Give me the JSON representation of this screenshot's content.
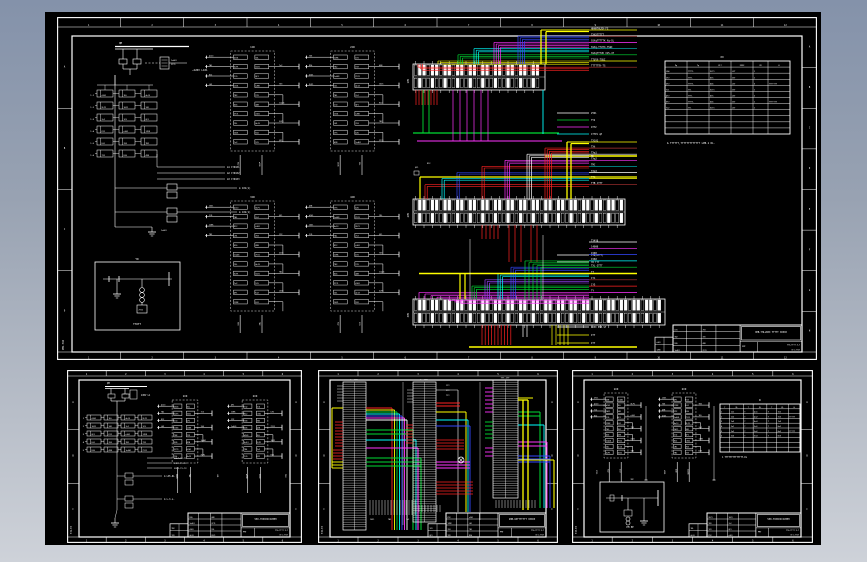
{
  "viewport": {
    "description": "CAD drawing preview",
    "background_top": "#8492aa",
    "background_bottom": "#ced2d9",
    "canvas_color": "#000000",
    "line_color": "#ffffff"
  },
  "wire_colors": {
    "red": "#ff2222",
    "darkred": "#b03434",
    "yellow": "#ffff00",
    "green": "#00dd33",
    "teal": "#00a0a0",
    "cyan": "#00ffff",
    "blue": "#3448ff",
    "magenta": "#ff33ff",
    "violet": "#9a44ff",
    "white": "#ffffff"
  },
  "smudges": [
    "1n401",
    "2YJ1",
    "d101",
    "1DL",
    "4n13",
    "XLP1",
    "1021",
    "TA1",
    "7n2",
    "1CD",
    "QF1",
    "K12",
    "n301",
    "1ZKK",
    "LH1",
    "703",
    "TB2",
    "1YX",
    "D26",
    "4XB"
  ],
  "sheets": {
    "main": {
      "zones_top": [
        "1",
        "2",
        "3",
        "4",
        "5",
        "6",
        "7",
        "8",
        "9",
        "10",
        "11",
        "12"
      ],
      "zones_bottom": [
        "1",
        "2",
        "3",
        "4",
        "5",
        "6",
        "7",
        "8",
        "9",
        "10",
        "11",
        "12"
      ],
      "zones_left": [
        "A",
        "B",
        "C",
        "D"
      ],
      "zones_right": [
        "A",
        "B",
        "C",
        "D",
        "E",
        "F",
        "G",
        "H"
      ],
      "bus_label": "QM",
      "supply_label": "~220V L101",
      "relay_rows": [
        "1-1",
        "1-2",
        "1-3",
        "1-4",
        "1-5",
        "1-6"
      ],
      "grid_refs": [
        "m1 1YD101",
        "m2 1YD102",
        "m3 1YD103"
      ],
      "sub_circuits": [
        "m 101(1)",
        "m 102(1)"
      ],
      "legend_box": {
        "title": "YD",
        "caption": "TTUTT"
      },
      "module_titles": [
        "1CD",
        "2CD",
        "3CD",
        "4CD"
      ],
      "strip_names": [
        "1YD",
        "2YD",
        "3YD"
      ],
      "strip1_labels": [
        {
          "c": "yellow",
          "t": "HHHHTHLRX-FS"
        },
        {
          "c": "darkred",
          "t": "TXXXTTTTT"
        },
        {
          "c": "magenta",
          "t": "SSXqTTTTTK Xq-SL"
        },
        {
          "c": "teal",
          "t": "SSXq-TTUTX-TSUI"
        },
        {
          "c": "green",
          "t": "SSXqTTTVK XVS-4T"
        },
        {
          "c": "yellow",
          "t": "TTUYX-TSUI"
        },
        {
          "c": "darkred",
          "t": "TTTTTTK-TS"
        }
      ],
      "strip1_sub_labels": [
        {
          "c": "white",
          "t": "2YD1"
        },
        {
          "c": "green",
          "t": "TY2"
        },
        {
          "c": "magenta",
          "t": "4TY2"
        },
        {
          "c": "cyan",
          "t": "1TYP1 qP"
        },
        {
          "c": "yellow",
          "t": "MC"
        }
      ],
      "strip2_labels": [
        {
          "c": "yellow",
          "t": "TX101"
        },
        {
          "c": "darkred",
          "t": "TXt"
        },
        {
          "c": "white",
          "t": "TXq1"
        },
        {
          "c": "magenta",
          "t": "TXq2"
        },
        {
          "c": "teal",
          "t": "TMC"
        },
        {
          "c": "white",
          "t": "TXq3"
        },
        {
          "c": "yellow",
          "t": "TTG"
        },
        {
          "c": "darkred",
          "t": "TTB JTTT"
        }
      ],
      "strip2_sub_labels": [
        {
          "c": "white",
          "t": "JTB(RTTT)"
        },
        {
          "c": "white",
          "t": "TB TTT"
        }
      ],
      "strip3_labels": [
        {
          "c": "white",
          "t": "TY4Y8"
        },
        {
          "c": "magenta",
          "t": "14000"
        },
        {
          "c": "blue",
          "t": "1500"
        },
        {
          "c": "cyan",
          "t": "1560"
        },
        {
          "c": "green",
          "t": "TXL GTTT"
        },
        {
          "c": "yellow",
          "t": "TT"
        },
        {
          "c": "darkred",
          "t": "1Y1"
        },
        {
          "c": "red",
          "t": "1Y5"
        },
        {
          "c": "magenta",
          "t": "TY"
        }
      ],
      "strip3_sub_labels": [
        {
          "c": "white",
          "t": "XXXX PhB-SY"
        },
        {
          "c": "yellow",
          "t": "ITT"
        },
        {
          "c": "yellow",
          "t": "ITT"
        }
      ],
      "table": {
        "title": "XX",
        "note": "Δ  TTTTTT,TTTTTTTTTTTTT LPB-1 DL.",
        "headers": [
          "Pq",
          "Tq",
          "XLT",
          "XXXX",
          "XX",
          "H"
        ],
        "rows": [
          [
            "LD4",
            "TTTTL",
            "XLT1",
            "LXT",
            "1",
            ""
          ],
          [
            "1YJ",
            "TTTL",
            "D1h",
            "1XT",
            "1",
            ""
          ],
          [
            "2YJ",
            "TTTTL",
            "D26",
            "LXT",
            "3",
            "TTTTTTT"
          ],
          [
            "TL1",
            "TTL",
            "XLT1",
            "1XT",
            "1",
            ""
          ],
          [
            "4YJ",
            "TTTL",
            "D1h",
            "LXT",
            "2",
            ""
          ],
          [
            "5YJ",
            "TTTTL",
            "D26",
            "1XT",
            "1",
            "TTTTTTT"
          ],
          [
            "TL2",
            "TTL",
            "XLT1",
            "LXT",
            "1",
            ""
          ]
        ]
      },
      "side_text": "PM1-TXX",
      "title_block": {
        "drawing_title": "XHB-YHLLBXX TTTTT XXXXX",
        "footer_small": "PMT",
        "footer_line1": "TTG-TTTT X-T",
        "footer_line2": "1T1-TT1T"
      }
    },
    "bottom_left": {
      "zones_top": [
        "1",
        "2",
        "3",
        "4",
        "5",
        "6"
      ],
      "zones_bottom": [
        "1",
        "2",
        "3",
        "4",
        "5",
        "6"
      ],
      "zones_left": [
        "A",
        "B",
        "C"
      ],
      "zones_right": [
        "A",
        "B",
        "C"
      ],
      "bus_label": "QM",
      "supply_label": "220V L1",
      "relay_rows": [
        "1",
        "2",
        "3",
        "4",
        "5"
      ],
      "grid_refs": [
        "XXLP-TX-TX",
        "XXLP-TX-TX",
        "XXLP-TX-TX"
      ],
      "sub_circuits": [
        "m LPh-DL",
        "m L-h.L-"
      ],
      "module_titles": [
        "1CD",
        "2CD"
      ],
      "side_text": "YJ1-TX",
      "title_block": {
        "drawing_title": "550-YXXXXIIIJHHH",
        "footer_small": "PMT",
        "footer_line1": "TTG-TTTT X-T",
        "footer_line2": "1T1-TT1T"
      }
    },
    "bottom_middle": {
      "zones_top": [
        "1",
        "2",
        "3",
        "4",
        "5",
        "6"
      ],
      "zones_bottom": [
        "1",
        "2",
        "3",
        "4",
        "5",
        "6"
      ],
      "zones_left": [
        "A",
        "B",
        "C"
      ],
      "zones_right": [
        "A",
        "B",
        "C"
      ],
      "ladder_titles": [
        "1n-1TY",
        "1n-3TY",
        "TTT-1TY"
      ],
      "device_labels": [
        "1YJ",
        "2YJ",
        "TYJ"
      ],
      "side_text": "YJ2-TX",
      "title_block": {
        "drawing_title": "2HB-UXTTTTTTT XXXXX",
        "footer_small": "PMT",
        "footer_line1": "TTG-TTTT X-T",
        "footer_line2": "1T1-TT1T"
      }
    },
    "bottom_right": {
      "zones_top": [
        "1",
        "2",
        "3",
        "4",
        "5",
        "6"
      ],
      "zones_bottom": [
        "1",
        "2",
        "3",
        "4",
        "5",
        "6"
      ],
      "zones_left": [
        "A",
        "B",
        "C"
      ],
      "zones_right": [
        "A",
        "B",
        "C"
      ],
      "module_titles": [
        "1CD",
        "2CD"
      ],
      "table": {
        "title": "D",
        "note": "1  TTTTTTTTTTTTTT-DL",
        "headers": [
          "T",
          "XL",
          "T",
          "XL",
          "T",
          "XL",
          "H"
        ],
        "rows": [
          [
            "1",
            "1n1",
            "T",
            "4n1",
            "T",
            "7n1",
            ""
          ],
          [
            "2",
            "1n2",
            "T",
            "4n2",
            "T",
            "7n2",
            "TTTTT"
          ],
          [
            "3",
            "1n3",
            "T",
            "4n3",
            "T",
            "7n3",
            ""
          ],
          [
            "4",
            "2n1",
            "T",
            "5n1",
            "T",
            "8n1",
            ""
          ],
          [
            "5",
            "2n2",
            "T",
            "5n2",
            "T",
            "8n2",
            "TTTTT"
          ],
          [
            "6",
            "2n3",
            "T",
            "5n3",
            "T",
            "8n3",
            ""
          ]
        ]
      },
      "box": {
        "title": "xx",
        "caption": "PM PP"
      },
      "side_text": "YJ3-TX",
      "title_block": {
        "drawing_title": "550-YXXXXIIIJHHH",
        "footer_small": "PMT",
        "footer_line1": "TTG-TTTT X-T",
        "footer_line2": "1T1-TT1T"
      }
    }
  }
}
